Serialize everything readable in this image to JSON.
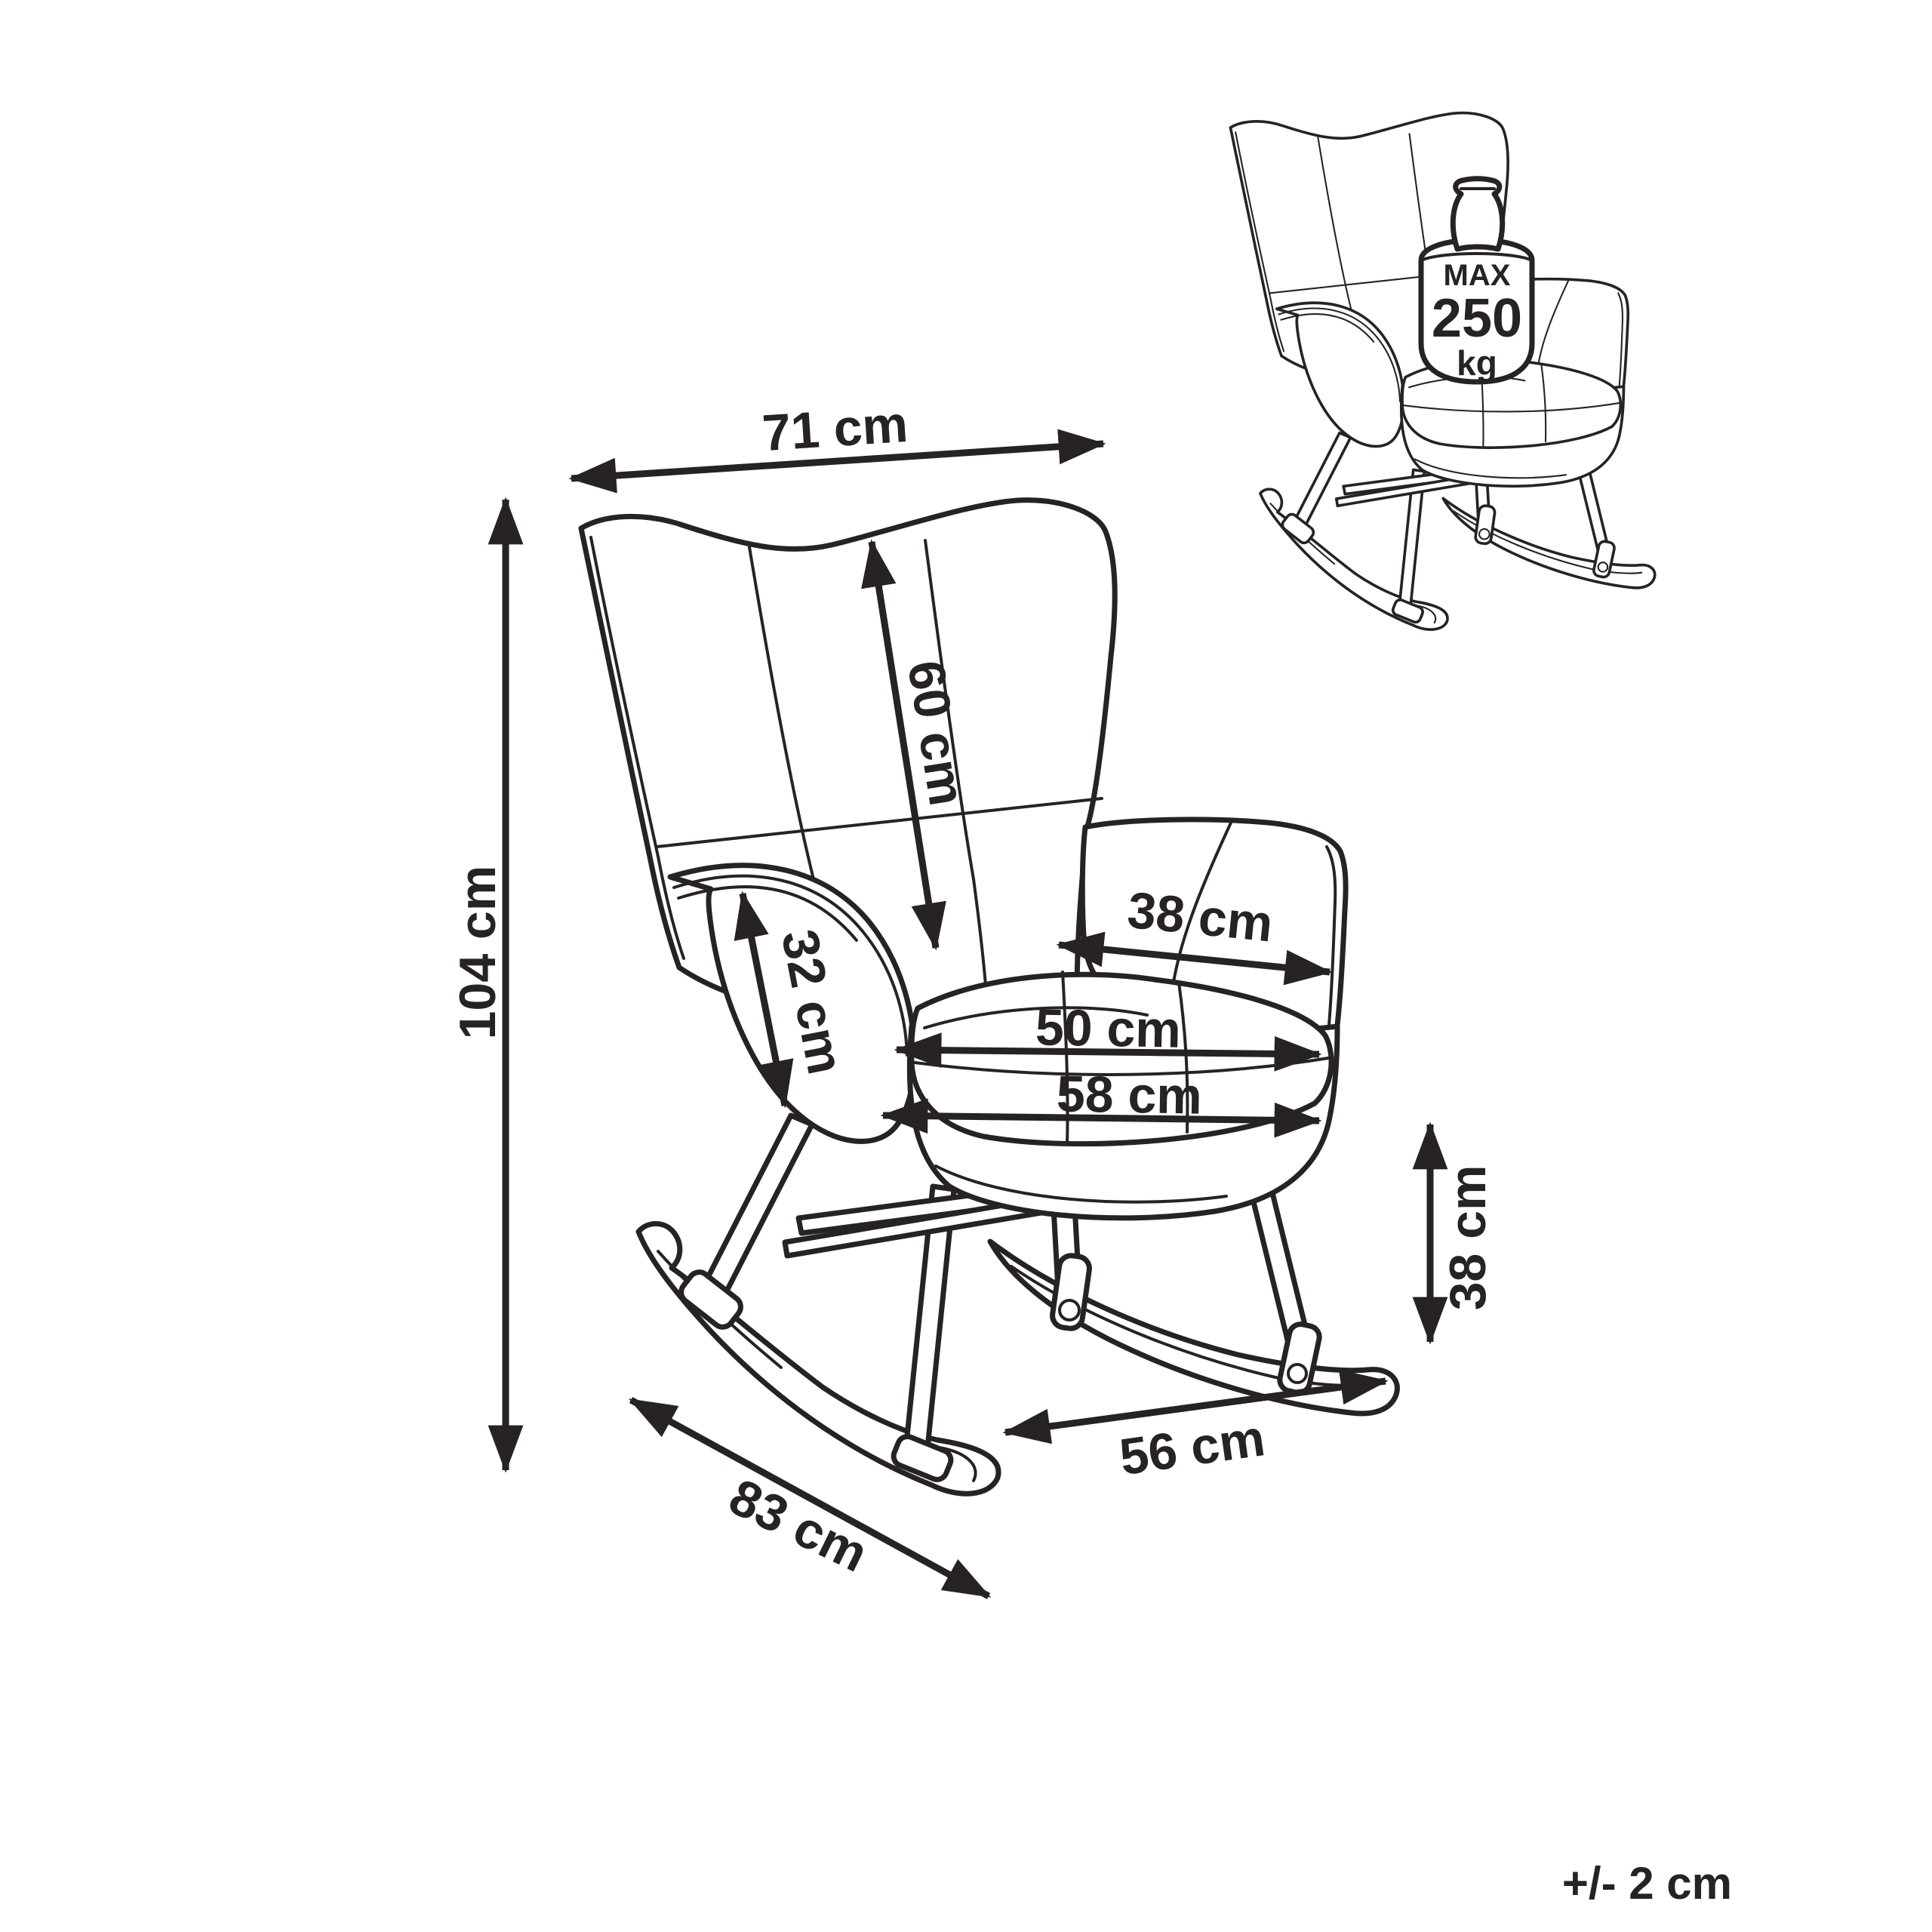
{
  "page": {
    "background": "#ffffff",
    "line_color": "#272223",
    "content": "rocking-chair-dimension-drawing"
  },
  "dimensions": {
    "overall_width": "71 cm",
    "overall_height": "104 cm",
    "backrest_height": "60 cm",
    "armrest_height": "32 cm",
    "armrest_depth": "38 cm",
    "seat_width": "50 cm",
    "seat_outer_width": "58 cm",
    "seat_height": "38 cm",
    "rocker_rear_span": "56 cm",
    "rocker_length": "83 cm"
  },
  "max_load_badge": {
    "line1": "MAX",
    "line2": "250",
    "line3": "kg"
  },
  "tolerance_note": "+/- 2 cm"
}
